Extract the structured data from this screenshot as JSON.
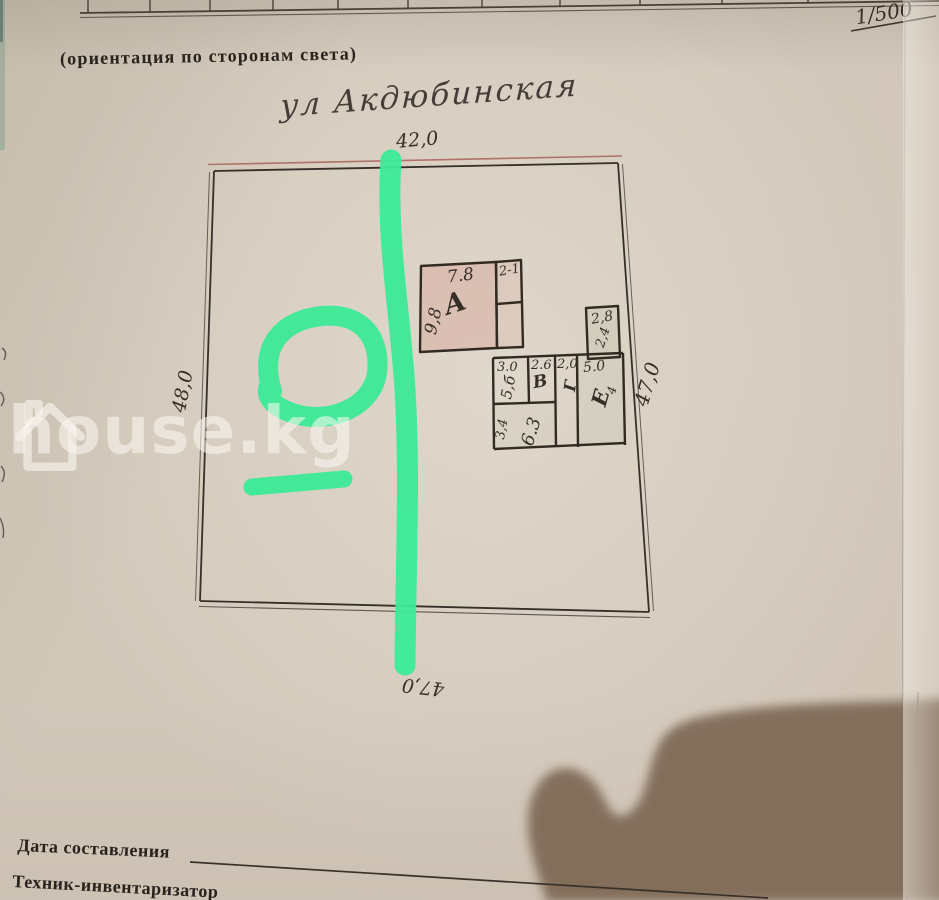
{
  "document": {
    "scale_note": "1/500",
    "orientation_caption": "(ориентация по сторонам света)",
    "street_name": "ул Акдюбинская",
    "footer": {
      "date_label": "Дата составления",
      "technician_label": "Техник-инвентаризатор"
    }
  },
  "plot": {
    "dim_top": "42,0",
    "dim_left": "48,0",
    "dim_right": "47,0",
    "dim_bottom": "47,0"
  },
  "building": {
    "room_a": {
      "label": "А",
      "width": "7.8",
      "depth": "9,8"
    },
    "annex_width": "2-1",
    "shed": {
      "width": "2,8",
      "note": "2,4"
    },
    "cell_b": {
      "width": "3.0",
      "note": "5,б"
    },
    "cell_v": {
      "label": "В",
      "width": "2.6"
    },
    "cell_g": {
      "label": "Г",
      "width": "2,0"
    },
    "cell_e": {
      "label": "Е",
      "width": "5.0",
      "note": "4"
    },
    "cell_bottom": {
      "width": "6.3",
      "depth": "3,4"
    }
  },
  "watermark": {
    "brand": "house.kg"
  },
  "colors": {
    "marker_green": "#3BEB97",
    "paper": "#d2c8ba",
    "room_pink": "#d89e93",
    "ink": "#332b22",
    "red_line": "#a8625c"
  }
}
